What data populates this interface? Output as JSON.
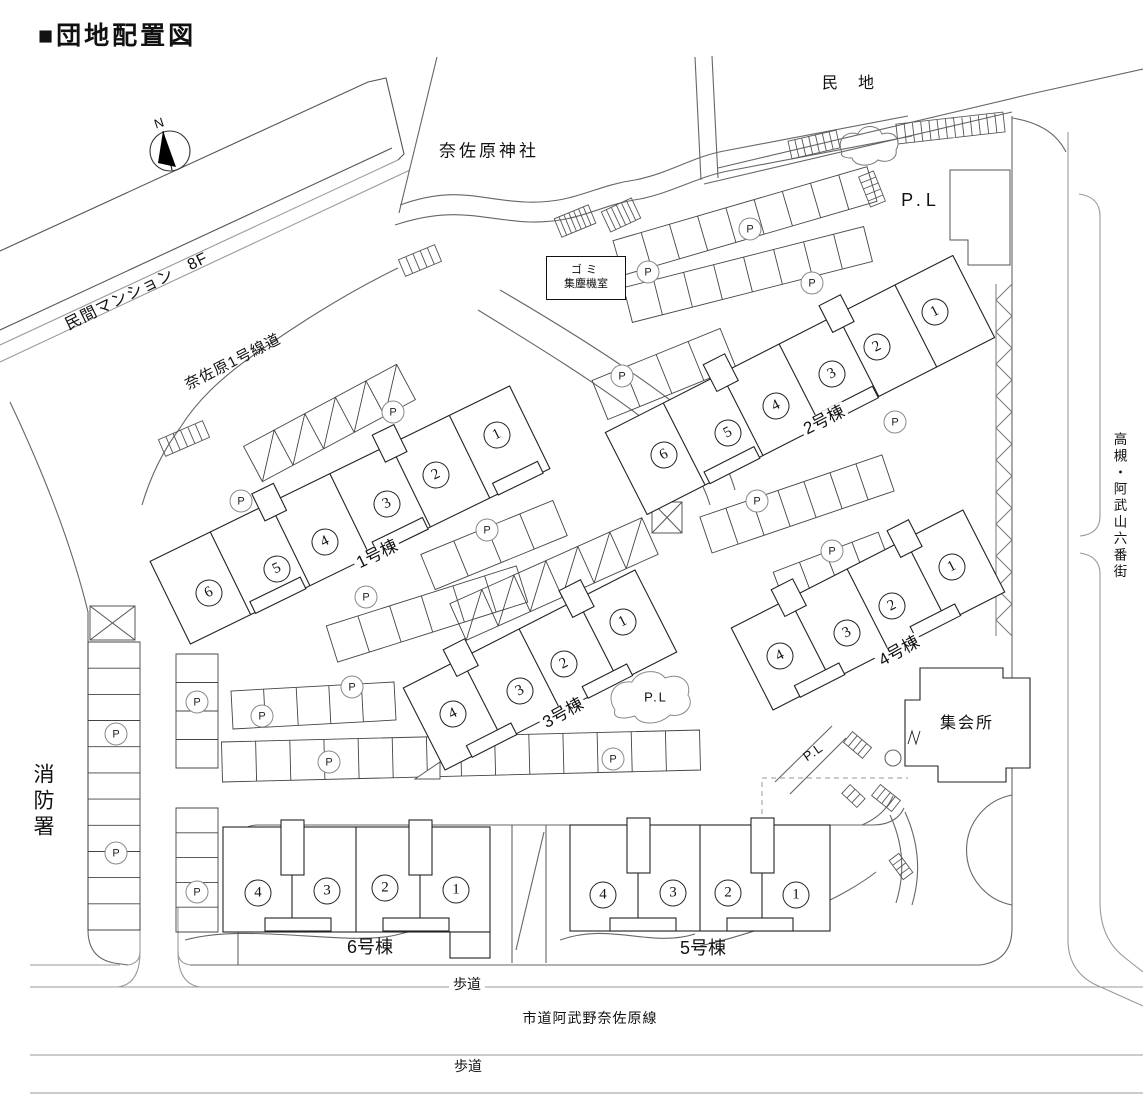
{
  "title": "■団地配置図",
  "compass": {
    "north": "N"
  },
  "labels": {
    "mansion": "民間マンション　8F",
    "shrine": "奈佐原神社",
    "private_land": "民　地",
    "nasahara_road": "奈佐原1号線道",
    "street_east": "高槻・阿武山六番街",
    "fire_station": "消防署",
    "sidewalk": "歩道",
    "city_road": "市道阿武野奈佐原線",
    "meeting_hall": "集会所",
    "garbage_room": [
      "ゴミ",
      "集塵機室"
    ],
    "pl": "P.L",
    "parking": "P"
  },
  "buildings": [
    {
      "name": "1号棟",
      "units": [
        "1",
        "2",
        "3",
        "4",
        "5",
        "6"
      ]
    },
    {
      "name": "2号棟",
      "units": [
        "1",
        "2",
        "3",
        "4",
        "5",
        "6"
      ]
    },
    {
      "name": "3号棟",
      "units": [
        "1",
        "2",
        "3",
        "4"
      ]
    },
    {
      "name": "4号棟",
      "units": [
        "1",
        "2",
        "3",
        "4"
      ]
    },
    {
      "name": "5号棟",
      "units": [
        "1",
        "2",
        "3",
        "4"
      ]
    },
    {
      "name": "6号棟",
      "units": [
        "1",
        "2",
        "3",
        "4"
      ]
    }
  ]
}
